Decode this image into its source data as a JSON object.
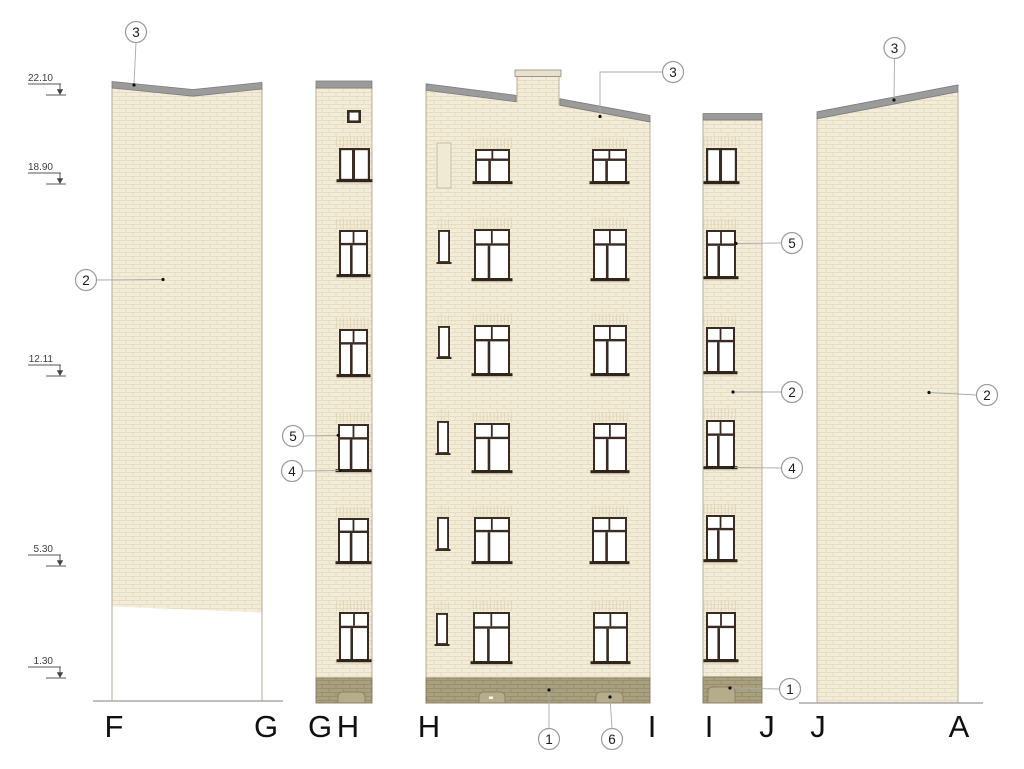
{
  "drawing": {
    "kind": "building facade elevations",
    "colors": {
      "facade": "#f2ecd9",
      "mortar": "#e3dabc",
      "roof_cap": "#9b9b9b",
      "base_band": "#a9a080",
      "window_frame": "#3a2b22"
    }
  },
  "elevation_markers": [
    "22.10",
    "18.90",
    "12.11",
    "5.30",
    "1.30"
  ],
  "axis_labels": [
    "F",
    "G",
    "G",
    "H",
    "H",
    "I",
    "I",
    "J",
    "J",
    "A"
  ],
  "callouts": {
    "fg_top": "3",
    "fg_wall": "2",
    "gh_window_head": "5",
    "gh_window_sill": "4",
    "hi_roof": "3",
    "hi_base": "1",
    "hi_arch": "6",
    "ij_window_head": "5",
    "ij_wall": "2",
    "ij_window_sill": "4",
    "ij_base": "1",
    "ja_roof": "3",
    "ja_wall": "2"
  }
}
